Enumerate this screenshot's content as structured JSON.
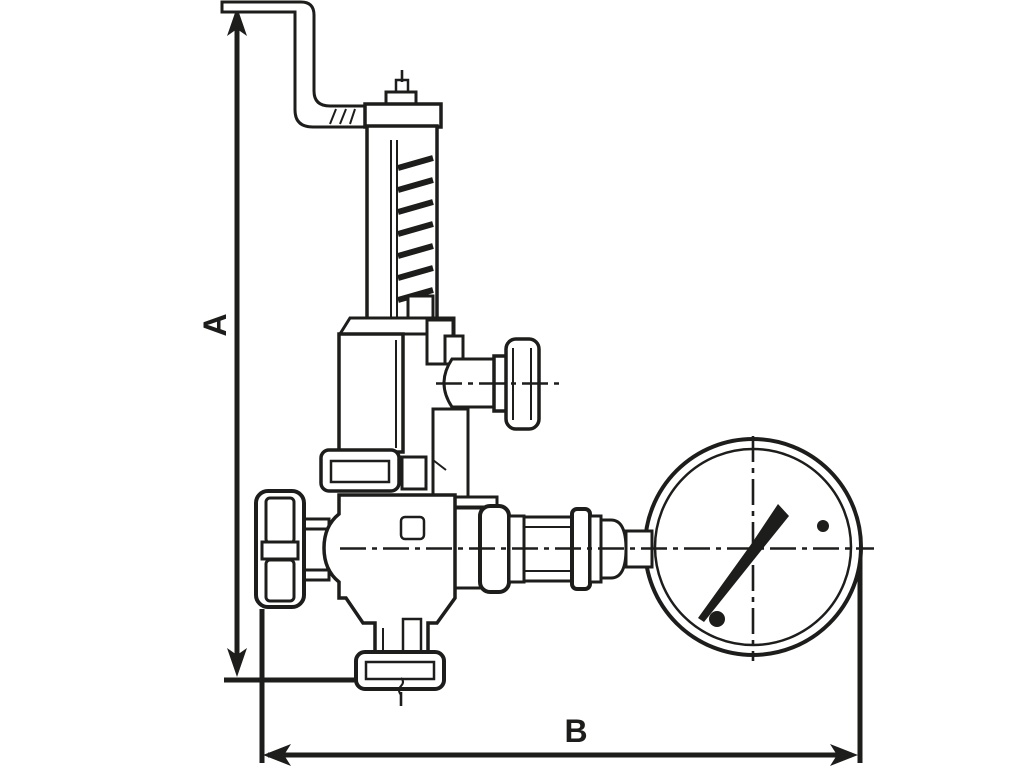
{
  "page": {
    "background": "#ffffff"
  },
  "drawing": {
    "stroke_color": "#1d1d1b",
    "kind": "technical-dimension-drawing",
    "components": [
      "test-lever-rod",
      "spring-housing",
      "bonnet-cylinder",
      "side-outlet-cap",
      "shutoff-handwheel",
      "valve-body",
      "union-fittings",
      "pressure-gauge",
      "bottom-union-nut"
    ]
  },
  "dimensions": {
    "a": {
      "label": "A",
      "orientation": "vertical"
    },
    "b": {
      "label": "B",
      "orientation": "horizontal"
    }
  }
}
